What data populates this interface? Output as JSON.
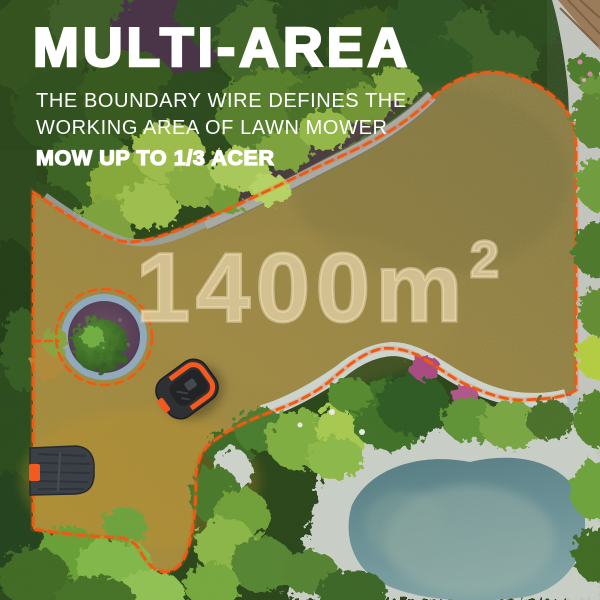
{
  "headline": {
    "title": "MULTI-AREA",
    "subtitle_line1": "THE BOUNDARY WIRE DEFINES THE",
    "subtitle_line2": "WORKING AREA OF LAWN MOWER",
    "badge": "MOW UP TO 1/3 ACER"
  },
  "area_label": {
    "value": "1400m",
    "superscript": "2"
  },
  "colors": {
    "headline_text": "#ffffff",
    "area_text": "#f0deb8",
    "boundary_wire": "#f2570f",
    "mower_accent": "#f4581c"
  }
}
